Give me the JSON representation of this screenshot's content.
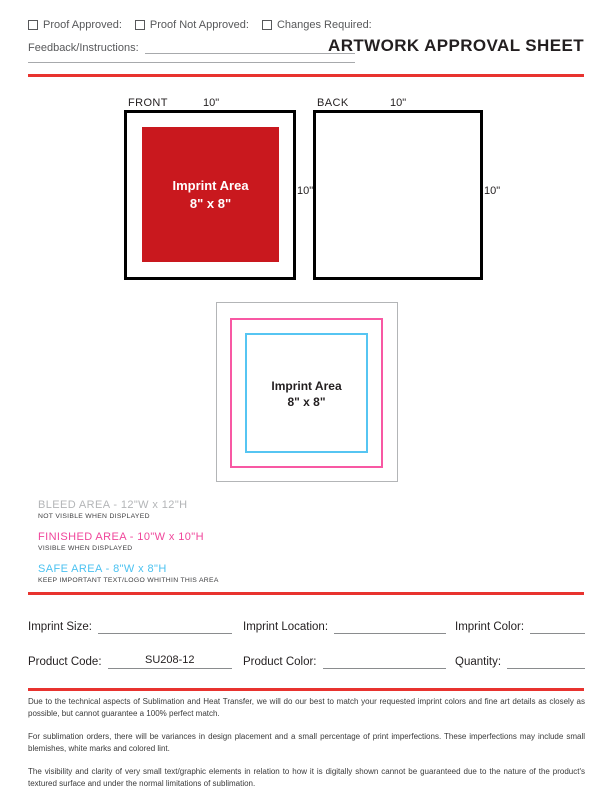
{
  "header": {
    "title": "ARTWORK APPROVAL SHEET"
  },
  "approval": {
    "checkboxes": [
      {
        "label": "Proof Approved:"
      },
      {
        "label": "Proof Not Approved:"
      },
      {
        "label": "Changes Required:"
      }
    ],
    "feedback_label": "Feedback/Instructions:"
  },
  "views": [
    {
      "name": "FRONT",
      "width_label": "10\"",
      "height_label": "10\"",
      "imprint": {
        "line1": "Imprint Area",
        "line2": "8\" x 8\""
      }
    },
    {
      "name": "BACK",
      "width_label": "10\"",
      "height_label": "10\""
    }
  ],
  "bleed_diagram": {
    "imprint_line1": "Imprint Area",
    "imprint_line2": "8\" x 8\""
  },
  "legend": [
    {
      "title": "BLEED AREA - 12\"W x 12\"H",
      "subtitle": "NOT VISIBLE WHEN DISPLAYED",
      "color": "#b3b5b7"
    },
    {
      "title": "FINISHED AREA - 10\"W x 10\"H",
      "subtitle": "VISIBLE WHEN DISPLAYED",
      "color": "#f0469b"
    },
    {
      "title": "SAFE AREA - 8\"W x 8\"H",
      "subtitle": "KEEP IMPORTANT TEXT/LOGO WHITHIN THIS AREA",
      "color": "#4bc2f1"
    }
  ],
  "form": {
    "fields": [
      {
        "label": "Imprint Size:",
        "value": ""
      },
      {
        "label": "Imprint Location:",
        "value": ""
      },
      {
        "label": "Imprint Color:",
        "value": ""
      },
      {
        "label": "Product Code:",
        "value": "SU208-12"
      },
      {
        "label": "Product Color:",
        "value": ""
      },
      {
        "label": "Quantity:",
        "value": ""
      }
    ]
  },
  "disclaimers": [
    "Due to the technical aspects of Sublimation and Heat Transfer, we will do our best to match your requested imprint colors and fine art details as closely as possible, but cannot guarantee a 100% perfect match.",
    "For sublimation orders, there will be variances in design placement and a small percentage of print imperfections. These imperfections may include small blemishes, white marks and colored lint.",
    "The visibility and clarity of very small text/graphic elements in relation to how it is digitally shown cannot be guaranteed due to the nature of the product's textured surface and under the normal limitations of sublimation."
  ],
  "colors": {
    "accent_red": "#e8332f",
    "imprint_red": "#c9181e",
    "bleed_gray": "#b3b5b7",
    "finished_magenta": "#f858a3",
    "safe_cyan": "#56c5f2"
  }
}
